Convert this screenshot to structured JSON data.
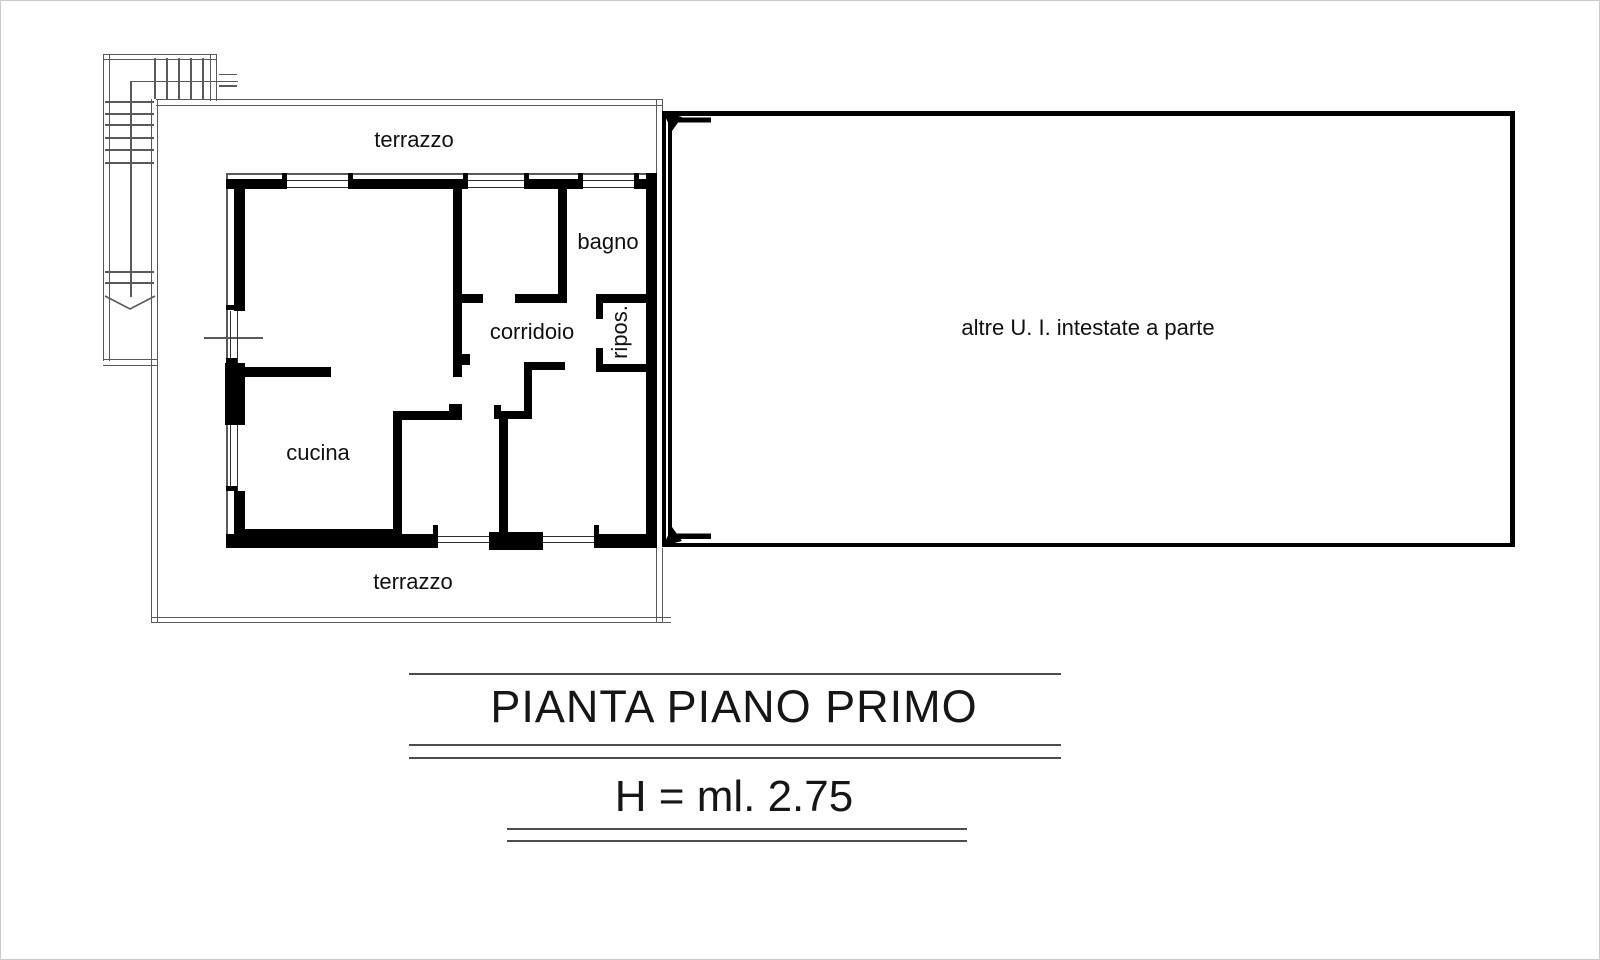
{
  "plan": {
    "room_labels": {
      "terrazzo_top": "terrazzo",
      "terrazzo_bottom": "terrazzo",
      "bagno": "bagno",
      "corridoio": "corridoio",
      "ripostiglio": "ripos.",
      "cucina": "cucina"
    },
    "adjacent_area_label": "altre U. I. intestate a parte",
    "title": "PIANTA PIANO PRIMO",
    "height_note": "H = ml. 2.75",
    "colors": {
      "walls": "#000000",
      "thin_lines": "#5a5a5a",
      "text": "#111111",
      "background": "#ffffff"
    }
  }
}
